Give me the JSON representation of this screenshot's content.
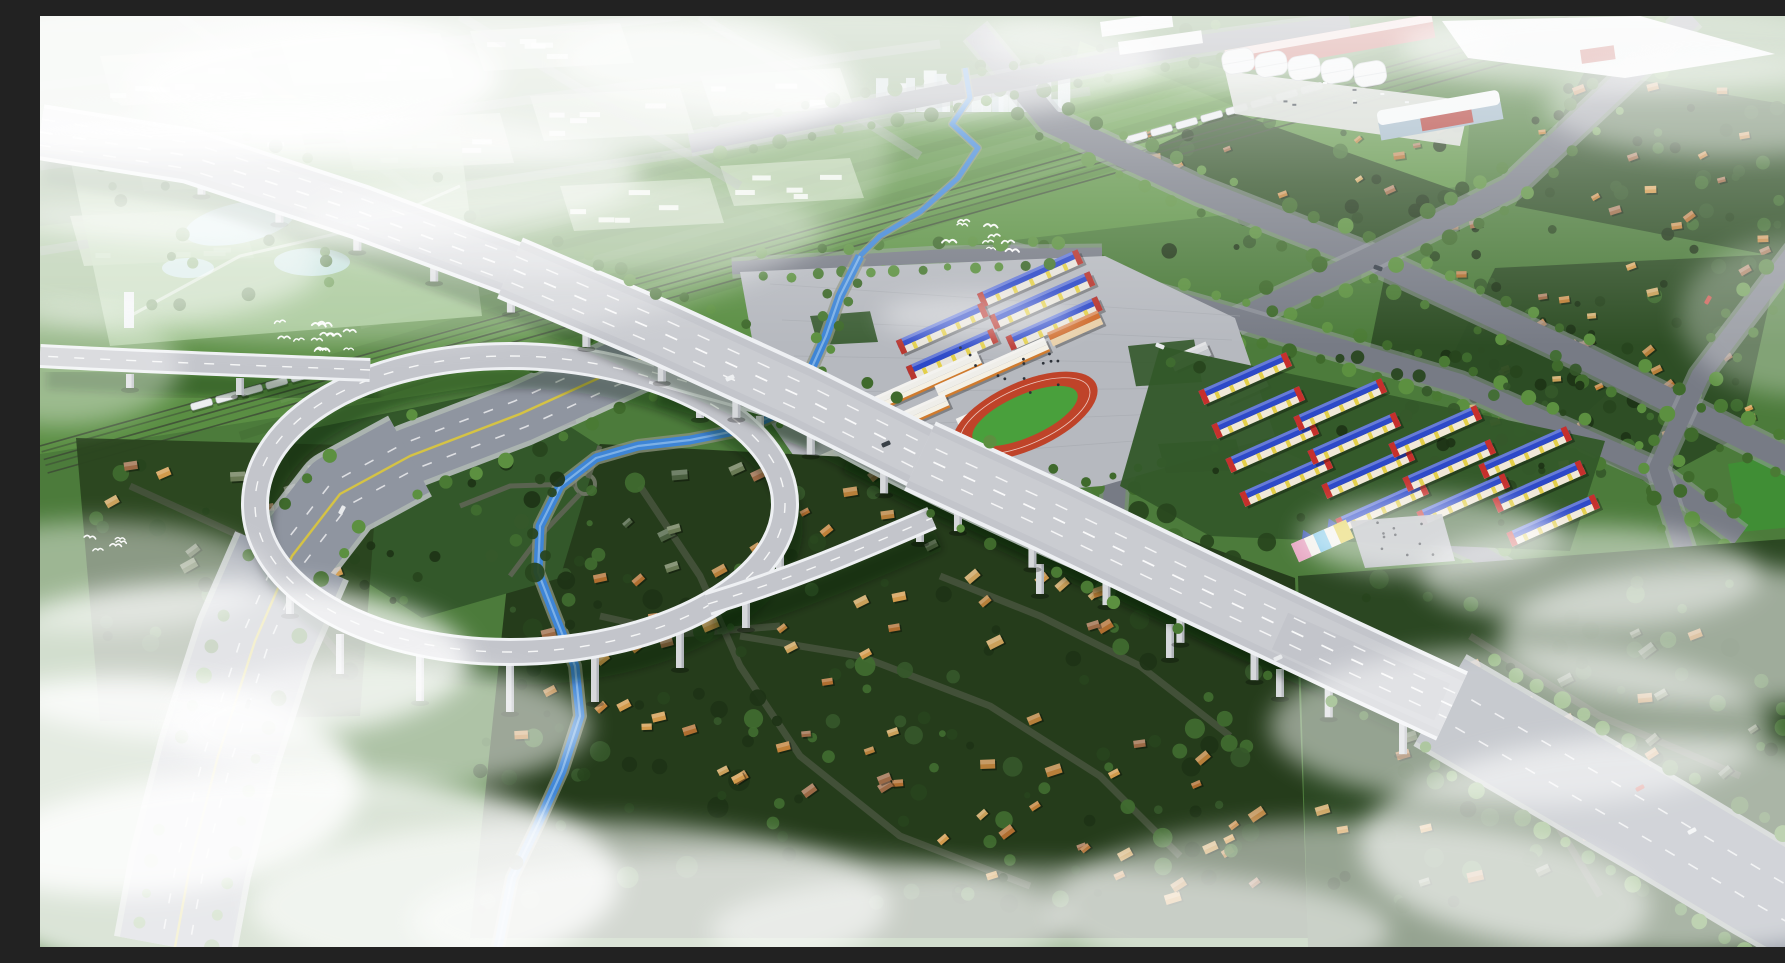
{
  "scene": {
    "title": "Aerial 3D rendering of a planned expressway interchange and new town district",
    "type": "architectural-visualization",
    "view": "oblique bird's-eye view",
    "atmosphere": "morning haze with low white cloud banks over the corners",
    "regions": [
      {
        "name": "distant-city-skyline",
        "description": "hazy white mid-rise towers on the horizon at top center"
      },
      {
        "name": "planned-city-grid",
        "description": "faint pale building blocks and street grid fading into fog, upper left"
      },
      {
        "name": "industrial-park",
        "description": "white barrel-roof factory halls with red walls and flat white warehouses, top right"
      },
      {
        "name": "exhibition-hall",
        "description": "modern white hall with red glazed band near the factories"
      },
      {
        "name": "elevated-expressway",
        "description": "light gray viaduct with white barriers crossing the site diagonally on piers"
      },
      {
        "name": "loop-ramp",
        "description": "large circular elevated ramp sweeping over the old village"
      },
      {
        "name": "school-campus",
        "description": "gray paved campus with blue-roof dormitory rows, orange-trimmed classroom buildings and a red running track"
      },
      {
        "name": "apartment-compound",
        "description": "rows of red apartment blocks with blue gable roofs, yellow banding and a colorful castle-like kindergarten"
      },
      {
        "name": "old-village",
        "description": "dense village of orange and tan roofed houses among dark green trees, lower half"
      },
      {
        "name": "canal",
        "description": "blue S-curving canal flowing from the city through the campus edge to the village"
      },
      {
        "name": "railway",
        "description": "straight railway corridor with two white passenger trains crossing the green fields"
      },
      {
        "name": "boulevard",
        "description": "wide tree-lined surface road with a yellow center line running to the lower left corner"
      },
      {
        "name": "parkland",
        "description": "landscaped park with pale ponds at the upper left"
      },
      {
        "name": "tree-lined-avenues",
        "description": "wide gray avenues bordered by rows of green street trees on the right half"
      },
      {
        "name": "birds",
        "description": "three flocks of white gulls over the fields"
      },
      {
        "name": "fog-banks",
        "description": "soft white clouds over the top left, bottom left, bottom center and right edges"
      }
    ]
  },
  "palette": {
    "field_mid": "#4c7b3b",
    "field_bright": "#5d9245",
    "field_pale": "#7fae6a",
    "field_dark": "#33582a",
    "village_ground": "#253c1b",
    "village_ground2": "#2b4722",
    "block_green": "#2c4c24",
    "tree_dark": "#1d3316",
    "tree_mid": "#2c4a20",
    "tree_light": "#3f6a2e",
    "street_tree": "#4c7e36",
    "street_tree2": "#5f9342",
    "road_gray": "#777b85",
    "road_dark": "#46523c",
    "boulevard": "#8f95a0",
    "curb_light": "#c9ccd2",
    "deck": "#c3c5cb",
    "deck_light": "#cfd1d6",
    "barrier": "#eef0f3",
    "pier": "#d6d8db",
    "pier_shade": "#b3b6bc",
    "shadow": "rgba(10,20,10,0.32)",
    "canal": "#3e85d6",
    "canal_hl": "#a6cdf0",
    "canal_bank": "#8e9480",
    "yellow_line": "#d9c53f",
    "track_red": "#bf4329",
    "track_green": "#49a03c",
    "roof_blue": "#2d49c8",
    "wall_red": "#c6302c",
    "accent_yellow": "#e3cf4a",
    "wall_white": "#efeee9",
    "trim_orange": "#d07b2e",
    "roof_orange": "#c08038",
    "wall_tan": "#e6d6a6",
    "factory_white": "#eff1f2",
    "factory_red": "#b5443c",
    "plaza": "#b6b9bf",
    "pond": "#bfe2e6",
    "park": "#9cc48b",
    "skyline": "#dfe8ec",
    "train": "#eceef0",
    "rail": "#3c4836",
    "fog": "#ffffff",
    "bird": "#ffffff"
  },
  "procedural": {
    "roof_variants": [
      "#c08038",
      "#b06e30",
      "#d29a4c",
      "#9c6a46",
      "#caa05a",
      "#b77f3a"
    ],
    "green_roof_variants": [
      "#5a6a4a",
      "#4a5f3f",
      "#6a7a55"
    ],
    "tree_variants": [
      "#1d3316",
      "#27441d",
      "#35582a",
      "#406c30"
    ],
    "street_tree_variants": [
      "#4a7a34",
      "#5c9040",
      "#3f6a2c"
    ],
    "birds": {
      "clusters": [
        {
          "x": 270,
          "y": 318,
          "count": 12,
          "spread": 75
        },
        {
          "x": 62,
          "y": 525,
          "count": 5,
          "spread": 40
        },
        {
          "x": 925,
          "y": 218,
          "count": 9,
          "spread": 85
        }
      ]
    },
    "trains": [
      {
        "x": 150,
        "y": 388,
        "cars": 6
      },
      {
        "x": 1085,
        "y": 121,
        "cars": 8
      }
    ],
    "village_house_counts": {
      "central": 85,
      "northwest": 18,
      "southeast": 35,
      "right_blocks": 56
    },
    "apartment_rows": 14,
    "campus_blue_rows": 5,
    "campus_school_slabs": 5,
    "factory_halls": 5,
    "fog_patch_count": 24,
    "cars": [
      [
        690,
        362,
        -23,
        "#eef0f2"
      ],
      [
        846,
        428,
        -23,
        "#3a4148"
      ],
      [
        1238,
        642,
        -25,
        "#e8eaec"
      ],
      [
        1600,
        772,
        -28,
        "#c03a2e"
      ],
      [
        1652,
        815,
        -28,
        "#e8eaec"
      ],
      [
        1338,
        252,
        20,
        "#39414a"
      ],
      [
        1668,
        284,
        -60,
        "#c03a2e"
      ],
      [
        302,
        494,
        -62,
        "#e8eaec"
      ],
      [
        208,
        688,
        -70,
        "#49515a"
      ],
      [
        1120,
        330,
        22,
        "#e8eaec"
      ]
    ]
  }
}
